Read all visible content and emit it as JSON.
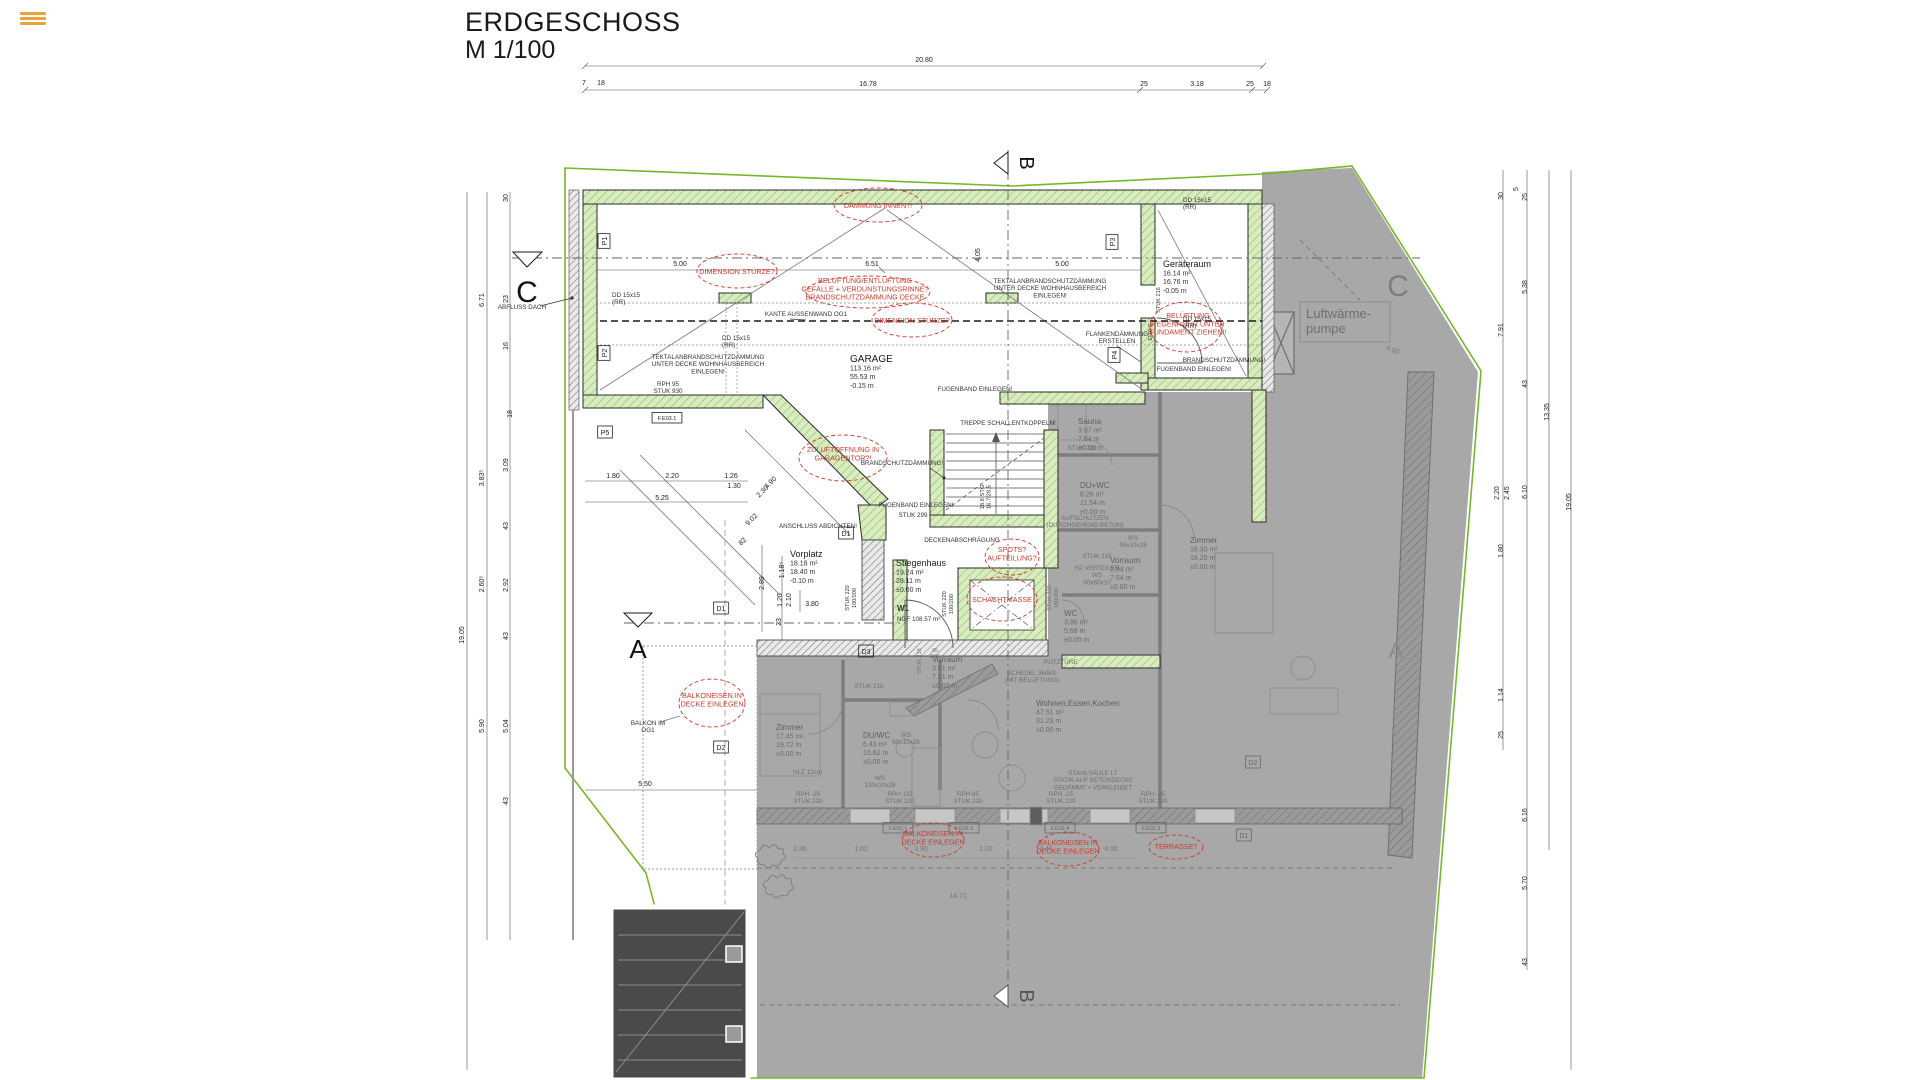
{
  "title": {
    "name": "ERDGESCHOSS",
    "scale": "M 1/100"
  },
  "palette": {
    "boundary_green": "#76b82a",
    "wall_green_fill": "#d9ecc0",
    "wall_green_hatch": "#8cbb66",
    "overlay_gray": "#a8a8a8",
    "annotation_red": "#cf3a2b",
    "line_dark": "#2b2b2b"
  },
  "sections": [
    {
      "t": "C",
      "x": 527,
      "y": 302,
      "c": "#111111",
      "s": 30
    },
    {
      "t": "C",
      "x": 1398,
      "y": 296,
      "c": "#7d7d7d",
      "s": 30
    },
    {
      "t": "A",
      "x": 638,
      "y": 658,
      "c": "#111111",
      "s": 26
    },
    {
      "t": "A",
      "x": 1396,
      "y": 658,
      "c": "#8a8a8a",
      "s": 22
    },
    {
      "t": "B",
      "x": 1020,
      "y": 163,
      "c": "#111111",
      "s": 20,
      "r": 90
    },
    {
      "t": "B",
      "x": 1020,
      "y": 996,
      "c": "#555555",
      "s": 20,
      "r": 90
    }
  ],
  "rooms": [
    {
      "name": "GARAGE",
      "area": "113.16 m²",
      "perim": "55.53 m",
      "level": "-0.15 m",
      "x": 850,
      "y": 362,
      "gray": false,
      "ns": 10
    },
    {
      "name": "Geräteraum",
      "area": "16.14 m²",
      "perim": "16.76 m",
      "level": "-0.05 m",
      "x": 1163,
      "y": 267,
      "gray": false,
      "ns": 9
    },
    {
      "name": "Vorplatz",
      "area": "18.18 m²",
      "perim": "18.40 m",
      "level": "-0.10 m",
      "x": 790,
      "y": 557,
      "gray": false,
      "ns": 9
    },
    {
      "name": "Stiegenhaus",
      "area": "19.24 m²",
      "perim": "28.11 m",
      "level": "±0.00 m",
      "x": 896,
      "y": 566,
      "gray": false,
      "ns": 9
    },
    {
      "name": "Sauna",
      "area": "3.07 m²",
      "perim": "7.64 m",
      "level": "±0.00 m",
      "x": 1078,
      "y": 424,
      "gray": true,
      "ns": 8
    },
    {
      "name": "DU+WC",
      "area": "8.28 m²",
      "perim": "11.54 m",
      "level": "±0.00 m",
      "x": 1080,
      "y": 488,
      "gray": true,
      "ns": 8
    },
    {
      "name": "Vorraum",
      "area": "2.94 m²",
      "perim": "7.54 m",
      "level": "±0.00 m",
      "x": 1110,
      "y": 563,
      "gray": true,
      "ns": 8
    },
    {
      "name": "Zimmer",
      "area": "18.30 m²",
      "perim": "18.20 m",
      "level": "±0.00 m",
      "x": 1190,
      "y": 543,
      "gray": true,
      "ns": 8
    },
    {
      "name": "WC",
      "area": "3.86 m²",
      "perim": "5.68 m",
      "level": "±0.00 m",
      "x": 1064,
      "y": 616,
      "gray": true,
      "ns": 8
    },
    {
      "name": "Vorraum",
      "area": "3.61 m²",
      "perim": "7.51 m",
      "level": "±0.00 m",
      "x": 932,
      "y": 662,
      "gray": true,
      "ns": 8
    },
    {
      "name": "Zimmer",
      "area": "17.45 m²",
      "perim": "19.72 m",
      "level": "±0.00 m",
      "x": 776,
      "y": 730,
      "gray": true,
      "ns": 8
    },
    {
      "name": "DU/WC",
      "area": "6.43 m²",
      "perim": "10.62 m",
      "level": "±0.00 m",
      "x": 863,
      "y": 738,
      "gray": true,
      "ns": 8
    },
    {
      "name": "Wohnen,Essen,Kochen",
      "area": "47.51 m²",
      "perim": "31.23 m",
      "level": "±0.00 m",
      "x": 1036,
      "y": 706,
      "gray": true,
      "ns": 8
    }
  ],
  "red_annotations": [
    {
      "t": "DÄMMUNG INNEN?!",
      "x": 878,
      "y": 208,
      "cl": [
        878,
        205,
        44,
        17
      ]
    },
    {
      "t": "DIMENSION STÜRZE?",
      "x": 737,
      "y": 274,
      "cl": [
        737,
        271,
        40,
        17
      ]
    },
    {
      "t": "DIMENSION STÜRZE?",
      "x": 912,
      "y": 323,
      "cl": [
        912,
        320,
        40,
        17
      ]
    },
    {
      "t": "BELÜFTUNG/ENTLÜFTUNG\nGEFÄLLE + VERDUNSTUNGSRINNE?\nBRANDSCHUTZDÄMMUNG DECKE",
      "x": 865,
      "y": 283,
      "cl": [
        868,
        292,
        62,
        16
      ]
    },
    {
      "t": "ZULUFTÖFFNUNG IN\nGARAGENTOR?!",
      "x": 843,
      "y": 452,
      "cl": [
        843,
        458,
        44,
        23
      ]
    },
    {
      "t": "SPOTS?\nAUFTEILUNG?",
      "x": 1012,
      "y": 552,
      "cl": [
        1012,
        557,
        27,
        18
      ]
    },
    {
      "t": "SCHACHTMASSE",
      "x": 1002,
      "y": 602,
      "cl": [
        1002,
        599,
        35,
        22
      ]
    },
    {
      "t": "BELÜFTUNG\nREGENROHR UNTER\nFUNDAMENT ZIEHEN!!",
      "x": 1188,
      "y": 318,
      "cl": [
        1186,
        327,
        36,
        25
      ]
    },
    {
      "t": "BALKONEISEN IN\nDECKE EINLEGEN",
      "x": 712,
      "y": 698,
      "cl": [
        712,
        703,
        33,
        24
      ]
    },
    {
      "t": "BALKONEISEN IN\nDECKE EINLEGEN",
      "x": 933,
      "y": 836,
      "cl": [
        933,
        840,
        31,
        17
      ]
    },
    {
      "t": "BALKONEISEN IN\nDECKE EINLEGEN",
      "x": 1068,
      "y": 845,
      "cl": [
        1068,
        849,
        31,
        17
      ]
    },
    {
      "t": "TERRASSE?",
      "x": 1176,
      "y": 849,
      "cl": [
        1176,
        847,
        27,
        12
      ]
    }
  ],
  "notes": [
    {
      "t": "ABFLUSS DACH",
      "x": 522,
      "y": 309
    },
    {
      "t": "DD 15x15\n(RR)",
      "x": 612,
      "y": 297,
      "a": "start"
    },
    {
      "t": "DD 15x15\n(RR)",
      "x": 722,
      "y": 340,
      "a": "start"
    },
    {
      "t": "DD 15x15\n(RR)",
      "x": 1183,
      "y": 202,
      "a": "start"
    },
    {
      "t": "DD 15x15\n(RR)",
      "x": 1183,
      "y": 321,
      "a": "start"
    },
    {
      "t": "KANTE AUSSENWAND OG1",
      "x": 806,
      "y": 316
    },
    {
      "t": "TEKTALANBRANDSCHUTZDÄMMUNG\nUNTER DECKE WOHNHAUSBEREICH\nEINLEGEN!",
      "x": 1050,
      "y": 283
    },
    {
      "t": "TEKTALANBRANDSCHUTZDÄMMUNG\nUNTER DECKE WOHNHAUSBEREICH\nEINLEGEN!",
      "x": 708,
      "y": 359
    },
    {
      "t": "RPH  95\nSTUK 930",
      "x": 668,
      "y": 386
    },
    {
      "t": "ANSCHLUSS ABDICHTEN!",
      "x": 818,
      "y": 528
    },
    {
      "t": "BRANDSCHUTZDÄMMUNG!",
      "x": 902,
      "y": 465
    },
    {
      "t": "FUGENBAND EINLEGEN!",
      "x": 975,
      "y": 391
    },
    {
      "t": "FUGENBAND EINLEGEN!",
      "x": 916,
      "y": 507
    },
    {
      "t": "STUK 299",
      "x": 913,
      "y": 517
    },
    {
      "t": "DECKENABSCHRÄGUNG",
      "x": 962,
      "y": 542
    },
    {
      "t": "TREPPE SCHALLENTKOPPELN!",
      "x": 1008,
      "y": 425
    },
    {
      "t": "FLANKENDÄMMUNG\nERSTELLEN",
      "x": 1117,
      "y": 336
    },
    {
      "t": "BRANDSCHUTZDÄMMUNG!",
      "x": 1224,
      "y": 362
    },
    {
      "t": "FUGENBAND EINLEGEN!",
      "x": 1194,
      "y": 371
    },
    {
      "t": "BALKON IM\nOG1",
      "x": 648,
      "y": 725
    },
    {
      "t": "W1",
      "x": 897,
      "y": 611,
      "a": "start",
      "s": 8,
      "w": "bold"
    },
    {
      "t": "NGF 108.57 m²",
      "x": 897,
      "y": 621,
      "a": "start"
    },
    {
      "t": "18.8 STG\n16.7/28.5",
      "x": 984,
      "y": 497,
      "r": -90,
      "s": 5.8
    },
    {
      "t": "EI30-C",
      "x": 1152,
      "y": 332,
      "r": -90,
      "s": 5.5
    },
    {
      "t": "STUK 216",
      "x": 1160,
      "y": 300,
      "r": -90,
      "s": 5.5
    },
    {
      "t": "STUK 220",
      "x": 849,
      "y": 598,
      "r": -90,
      "s": 5.5
    },
    {
      "t": "100/200",
      "x": 856,
      "y": 598,
      "r": -90,
      "s": 5.5
    },
    {
      "t": "STUK 220",
      "x": 946,
      "y": 604,
      "r": -90,
      "s": 5.5
    },
    {
      "t": "100/200",
      "x": 953,
      "y": 604,
      "r": -90,
      "s": 5.5
    }
  ],
  "notes_gray": [
    {
      "t": "Luftwärme-\npumpe",
      "x": 1306,
      "y": 318,
      "s": 13,
      "a": "start"
    },
    {
      "t": "AUFSCHLITZEN\n(DURCHGEHEND BETON)",
      "x": 1085,
      "y": 520
    },
    {
      "t": "WS\n65x10x28",
      "x": 1133,
      "y": 540
    },
    {
      "t": "HZ VERTEILER\nWS\n60x60x10",
      "x": 1097,
      "y": 570
    },
    {
      "t": "SCHEDEL 36/50L\n(MIT BELÜFTUNG)",
      "x": 1032,
      "y": 675
    },
    {
      "t": "PUTZTÜRE",
      "x": 1044,
      "y": 664,
      "a": "start"
    },
    {
      "t": "STAHLSÄULE LT\nSTATIK AUF BETONDECKE\nGEDÄMMT + VERKLEIDET",
      "x": 1093,
      "y": 775
    },
    {
      "t": "HLZ 12cm",
      "x": 822,
      "y": 774,
      "a": "end"
    },
    {
      "t": "WS\n130x10x28",
      "x": 880,
      "y": 780
    },
    {
      "t": "WS\n65x10x28",
      "x": 906,
      "y": 737
    },
    {
      "t": "RPH  -25\nSTUK 220",
      "x": 808,
      "y": 796
    },
    {
      "t": "RPH  115\nSTUK 220",
      "x": 900,
      "y": 796
    },
    {
      "t": "RPH  85\nSTUK 220",
      "x": 968,
      "y": 796
    },
    {
      "t": "RPH  -25\nSTUK 220",
      "x": 1061,
      "y": 796
    },
    {
      "t": "RPH  -25\nSTUK 220",
      "x": 1153,
      "y": 796
    },
    {
      "t": "STUK 215",
      "x": 869,
      "y": 688
    },
    {
      "t": "STUK 216",
      "x": 921,
      "y": 661,
      "r": -90,
      "s": 5.5
    },
    {
      "t": "95\n215",
      "x": 935,
      "y": 652,
      "s": 5.2
    },
    {
      "t": "STUK 210",
      "x": 1082,
      "y": 450
    },
    {
      "t": "STUK 215",
      "x": 1097,
      "y": 558
    },
    {
      "t": "STUK 220",
      "x": 1051,
      "y": 598,
      "r": -90,
      "s": 5.5
    },
    {
      "t": "100/200",
      "x": 1058,
      "y": 598,
      "r": -90,
      "s": 5.5
    }
  ],
  "tags": [
    {
      "t": "P1",
      "x": 607,
      "y": 241,
      "r": -90
    },
    {
      "t": "P2",
      "x": 607,
      "y": 353,
      "r": -90
    },
    {
      "t": "P5",
      "x": 605,
      "y": 435
    },
    {
      "t": "P3",
      "x": 1115,
      "y": 242,
      "r": -90
    },
    {
      "t": "P4",
      "x": 1117,
      "y": 355,
      "r": -90
    },
    {
      "t": "D1",
      "x": 846,
      "y": 536
    },
    {
      "t": "D1",
      "x": 721,
      "y": 611
    },
    {
      "t": "D2",
      "x": 721,
      "y": 750
    },
    {
      "t": "D3",
      "x": 866,
      "y": 654
    },
    {
      "t": "F.E03.1",
      "x": 667,
      "y": 420,
      "s": 5.5
    },
    {
      "t": "F.E02.1",
      "x": 898,
      "y": 830,
      "g": true,
      "s": 5.5
    },
    {
      "t": "F.E02.2",
      "x": 964,
      "y": 830,
      "g": true,
      "s": 5.5
    },
    {
      "t": "F.E02.4",
      "x": 1060,
      "y": 830,
      "g": true,
      "s": 5.5
    },
    {
      "t": "F.E02.3",
      "x": 1151,
      "y": 830,
      "g": true,
      "s": 5.5
    },
    {
      "t": "D2",
      "x": 1253,
      "y": 765,
      "g": true
    },
    {
      "t": "D1",
      "x": 1244,
      "y": 838,
      "g": true
    }
  ],
  "dimensions": [
    {
      "t": "20.80",
      "x": 924,
      "y": 62
    },
    {
      "t": "7",
      "x": 584,
      "y": 85
    },
    {
      "t": "18",
      "x": 601,
      "y": 85
    },
    {
      "t": "16.78",
      "x": 868,
      "y": 86
    },
    {
      "t": "25",
      "x": 1144,
      "y": 86
    },
    {
      "t": "3.18",
      "x": 1197,
      "y": 86
    },
    {
      "t": "25",
      "x": 1250,
      "y": 86
    },
    {
      "t": "18",
      "x": 1267,
      "y": 86
    },
    {
      "t": "19.05",
      "x": 464,
      "y": 635,
      "r": -90
    },
    {
      "t": "6.71",
      "x": 484,
      "y": 300,
      "r": -90
    },
    {
      "t": "3.83⁵",
      "x": 484,
      "y": 478,
      "r": -90
    },
    {
      "t": "2.60⁵",
      "x": 484,
      "y": 584,
      "r": -90
    },
    {
      "t": "5.90",
      "x": 484,
      "y": 726,
      "r": -90
    },
    {
      "t": "30",
      "x": 508,
      "y": 198,
      "r": -90
    },
    {
      "t": "23",
      "x": 508,
      "y": 299,
      "r": -90
    },
    {
      "t": "16",
      "x": 508,
      "y": 346,
      "r": -90
    },
    {
      "t": "18",
      "x": 512,
      "y": 414,
      "r": -90
    },
    {
      "t": "3.09",
      "x": 508,
      "y": 465,
      "r": -90
    },
    {
      "t": "43",
      "x": 508,
      "y": 526,
      "r": -90
    },
    {
      "t": "2.92",
      "x": 508,
      "y": 585,
      "r": -90
    },
    {
      "t": "43",
      "x": 508,
      "y": 636,
      "r": -90
    },
    {
      "t": "5.04",
      "x": 508,
      "y": 726,
      "r": -90
    },
    {
      "t": "43",
      "x": 508,
      "y": 801,
      "r": -90
    },
    {
      "t": "30",
      "x": 1503,
      "y": 196,
      "r": -90
    },
    {
      "t": "7.91",
      "x": 1503,
      "y": 330,
      "r": -90
    },
    {
      "t": "2.20",
      "x": 1499,
      "y": 493,
      "r": -90
    },
    {
      "t": "2.45",
      "x": 1509,
      "y": 493,
      "r": -90
    },
    {
      "t": "1.80",
      "x": 1503,
      "y": 551,
      "r": -90
    },
    {
      "t": "1.14",
      "x": 1503,
      "y": 695,
      "r": -90
    },
    {
      "t": "25",
      "x": 1503,
      "y": 735,
      "r": -90
    },
    {
      "t": "5",
      "x": 1518,
      "y": 189,
      "r": -90
    },
    {
      "t": "25",
      "x": 1527,
      "y": 197,
      "r": -90
    },
    {
      "t": "5.38",
      "x": 1527,
      "y": 287,
      "r": -90
    },
    {
      "t": "43",
      "x": 1527,
      "y": 384,
      "r": -90
    },
    {
      "t": "6.10",
      "x": 1527,
      "y": 492,
      "r": -90
    },
    {
      "t": "6.16",
      "x": 1527,
      "y": 815,
      "r": -90
    },
    {
      "t": "5.70",
      "x": 1527,
      "y": 883,
      "r": -90
    },
    {
      "t": "43",
      "x": 1527,
      "y": 962,
      "r": -90
    },
    {
      "t": "13.35",
      "x": 1549,
      "y": 412,
      "r": -90
    },
    {
      "t": "19.05",
      "x": 1571,
      "y": 502,
      "r": -90
    },
    {
      "t": "5.00",
      "x": 680,
      "y": 266
    },
    {
      "t": "6.51",
      "x": 872,
      "y": 266
    },
    {
      "t": "4.05",
      "x": 980,
      "y": 255,
      "r": -90
    },
    {
      "t": "5.00",
      "x": 1062,
      "y": 266
    },
    {
      "t": "1.80",
      "x": 613,
      "y": 478
    },
    {
      "t": "2.20",
      "x": 672,
      "y": 478
    },
    {
      "t": "1.26",
      "x": 731,
      "y": 478
    },
    {
      "t": "1.30",
      "x": 734,
      "y": 488
    },
    {
      "t": "5.25",
      "x": 662,
      "y": 500
    },
    {
      "t": "4.90",
      "x": 772,
      "y": 484,
      "r": -45
    },
    {
      "t": "2.30",
      "x": 764,
      "y": 493,
      "r": -45
    },
    {
      "t": "9.02",
      "x": 753,
      "y": 521,
      "r": -45
    },
    {
      "t": "82",
      "x": 744,
      "y": 543,
      "r": -45
    },
    {
      "t": "1.18⁵",
      "x": 784,
      "y": 570,
      "r": -90
    },
    {
      "t": "2.89",
      "x": 764,
      "y": 583,
      "r": -90
    },
    {
      "t": "1.20",
      "x": 782,
      "y": 600,
      "r": -90
    },
    {
      "t": "2.10",
      "x": 791,
      "y": 600,
      "r": -90
    },
    {
      "t": "3.80",
      "x": 812,
      "y": 606
    },
    {
      "t": "23",
      "x": 781,
      "y": 622,
      "r": -90
    },
    {
      "t": "5.50",
      "x": 645,
      "y": 786
    },
    {
      "t": "4.00",
      "x": 1392,
      "y": 352,
      "r": 20,
      "g": true
    },
    {
      "t": "2.36",
      "x": 800,
      "y": 851,
      "g": true
    },
    {
      "t": "1.02",
      "x": 861,
      "y": 851,
      "g": true
    },
    {
      "t": "3.90",
      "x": 921,
      "y": 851,
      "g": true
    },
    {
      "t": "1.02",
      "x": 986,
      "y": 851,
      "g": true
    },
    {
      "t": "2.46",
      "x": 1046,
      "y": 851,
      "g": true
    },
    {
      "t": "4.00",
      "x": 1111,
      "y": 851,
      "g": true
    },
    {
      "t": "14.71",
      "x": 958,
      "y": 898,
      "g": true
    }
  ]
}
